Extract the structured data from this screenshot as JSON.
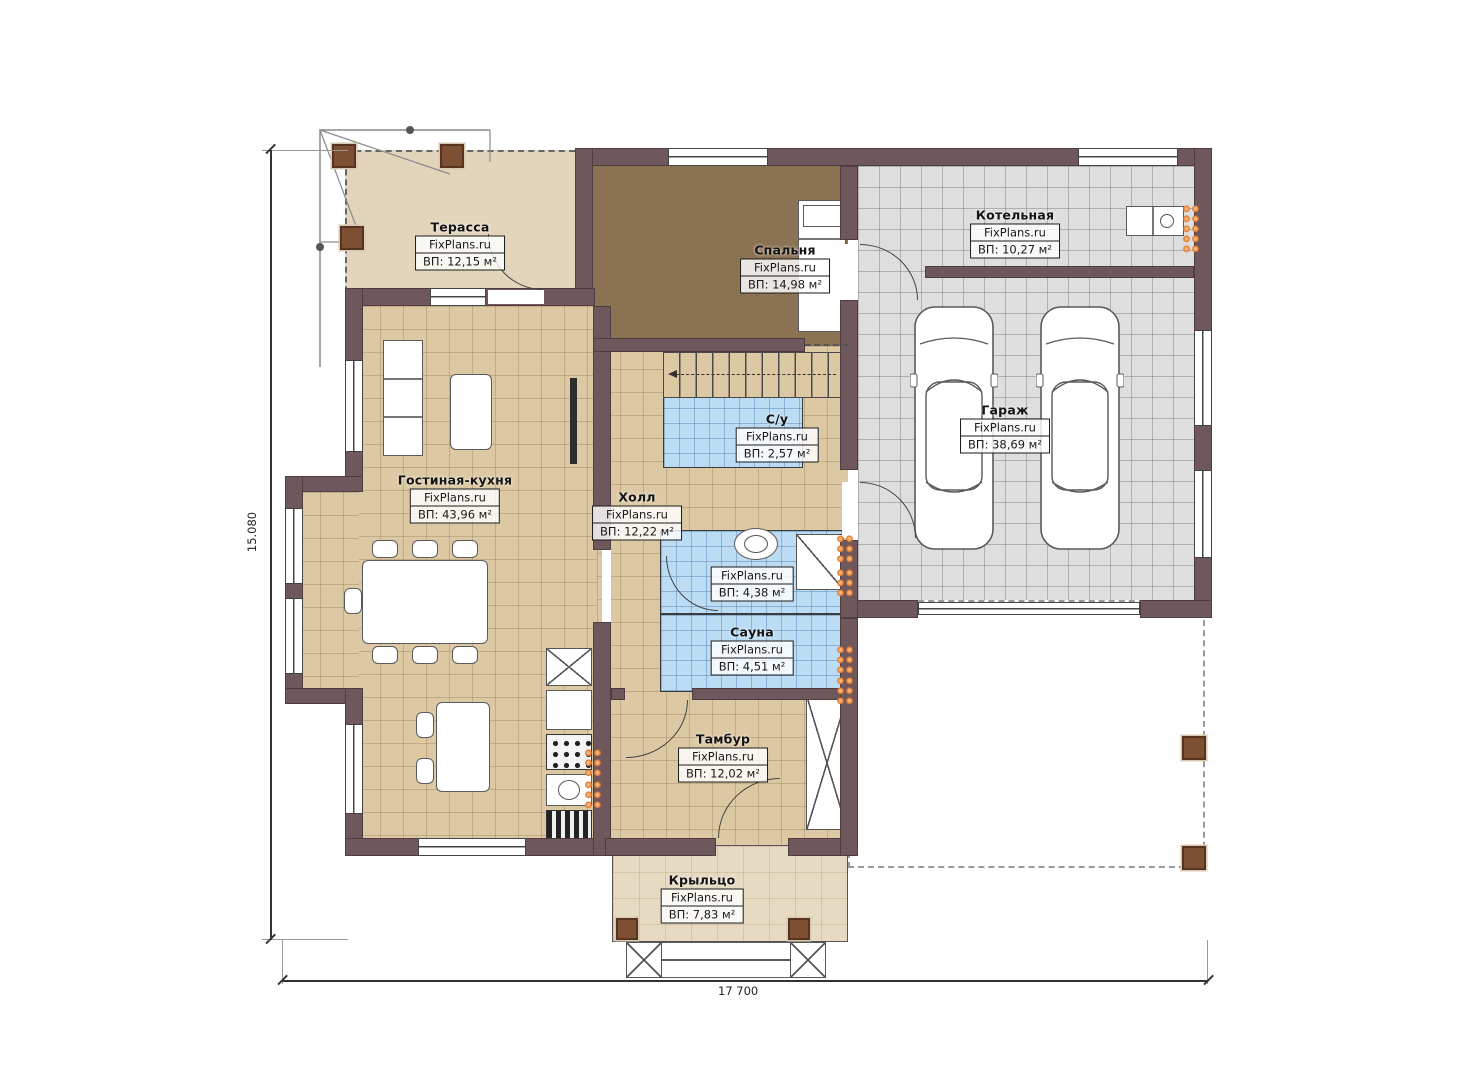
{
  "brand": "FixPlans.ru",
  "rooms": [
    {
      "name": "Терасса",
      "area": "ВП: 12,15 м²"
    },
    {
      "name": "Спальня",
      "area": "ВП: 14,98 м²"
    },
    {
      "name": "Котельная",
      "area": "ВП: 10,27 м²"
    },
    {
      "name": "Гараж",
      "area": "ВП: 38,69 м²"
    },
    {
      "name": "Гостиная-кухня",
      "area": "ВП: 43,96 м²"
    },
    {
      "name": "Холл",
      "area": "ВП: 12,22 м²"
    },
    {
      "name": "С/у",
      "area": "ВП: 2,57 м²"
    },
    {
      "name": "",
      "area": "ВП: 4,38 м²"
    },
    {
      "name": "Сауна",
      "area": "ВП: 4,51 м²"
    },
    {
      "name": "Тамбур",
      "area": "ВП: 12,02 м²"
    },
    {
      "name": "Крыльцо",
      "area": "ВП: 7,83 м²"
    }
  ],
  "dimensions": {
    "left": "15.080",
    "bottom": "17 700"
  },
  "colors": {
    "wall": "#6e585c",
    "floor_beige": "#dcc9a4",
    "floor_gray": "#dedede",
    "floor_blue": "#bcdcf4",
    "floor_bedroom": "#8a7253",
    "floor_terrace": "#e3d5bc",
    "radiator_orange": "#e0752a"
  }
}
